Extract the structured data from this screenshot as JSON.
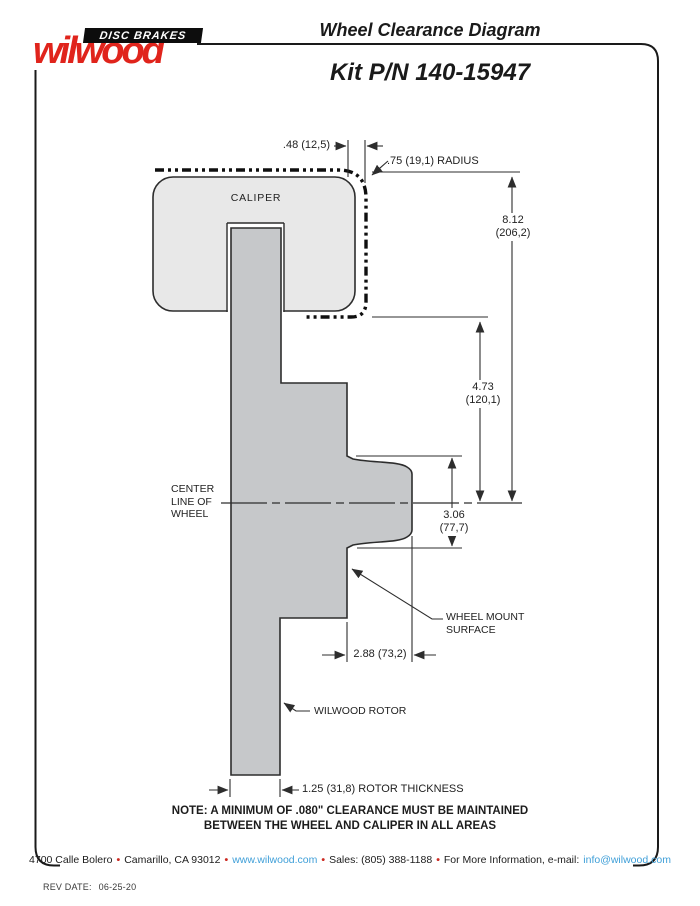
{
  "header": {
    "logo_brand": "wilwood",
    "logo_tagline": "DISC BRAKES",
    "title": "Wheel Clearance Diagram",
    "kit": "Kit P/N 140-15947"
  },
  "diagram": {
    "labels": {
      "caliper": "CALIPER",
      "centerline": [
        "CENTER",
        "LINE OF",
        "WHEEL"
      ],
      "wheel_mount": [
        "WHEEL MOUNT",
        "SURFACE"
      ],
      "rotor": "WILWOOD ROTOR"
    },
    "dimensions": {
      "caliper_overhang": ".48 (12,5)",
      "corner_radius": ".75 (19,1) RADIUS",
      "overall_height": [
        "8.12",
        "(206,2)"
      ],
      "caliper_to_centerline": [
        "4.73",
        "(120,1)"
      ],
      "hub_flange_height": [
        "3.06",
        "(77,7)"
      ],
      "mount_offset": "2.88 (73,2)",
      "rotor_thickness": "1.25 (31,8) ROTOR THICKNESS"
    },
    "note": [
      "NOTE: A MINIMUM OF .080\" CLEARANCE MUST BE MAINTAINED",
      "BETWEEN THE WHEEL AND CALIPER IN ALL AREAS"
    ]
  },
  "footer": {
    "address": "4700 Calle Bolero",
    "city": "Camarillo, CA 93012",
    "website": "www.wilwood.com",
    "sales": "Sales: (805) 388-1188",
    "more_info": "For More Information, e-mail:",
    "email": "info@wilwood.com",
    "separator": "•",
    "rev_label": "REV DATE:",
    "rev_date": "06-25-20"
  },
  "colors": {
    "brand_red": "#e0241c",
    "link_blue": "#3f9fd8",
    "caliper_fill": "#e8e8e8",
    "rotor_fill": "#c6c8ca",
    "line": "#2d2d2d"
  }
}
